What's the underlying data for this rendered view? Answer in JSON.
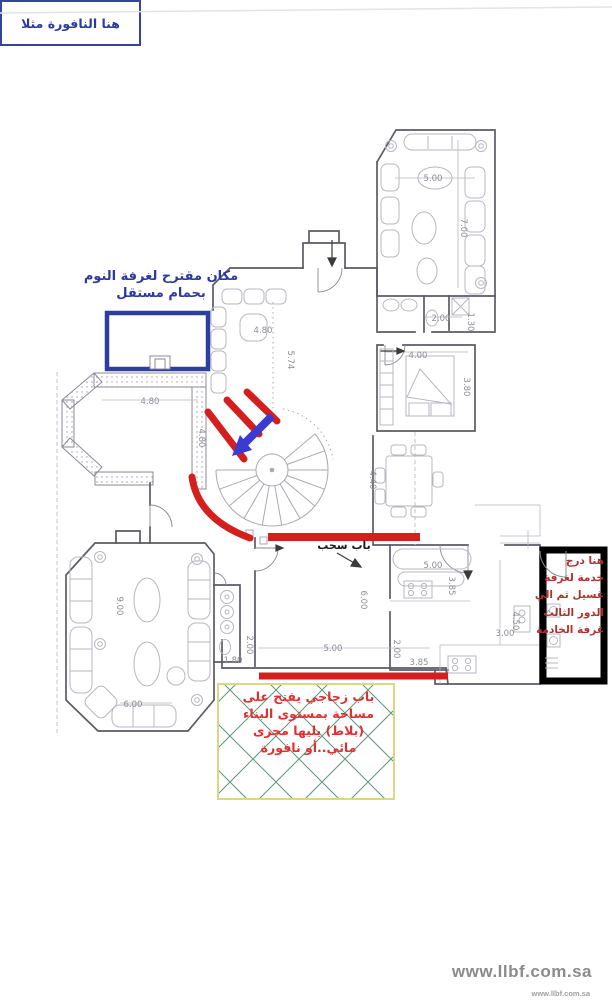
{
  "annotations": {
    "proposed_room": {
      "line1": "مكان مقترح لغرفة النوم",
      "line2": "بحمام مستقل",
      "color": "#2b3aa0"
    },
    "sliding_door": {
      "label": "باب سحب",
      "color": "#1a1a1a"
    },
    "service_stair": {
      "lines": [
        "هنا درج",
        "خدمة لغرفة",
        "غسيل ثم الي",
        "الدور الثالث",
        "غرفة الخادمة"
      ],
      "color": "#b03030"
    },
    "glass_door_note": {
      "lines": [
        "باب زجاجي يفتح على",
        "مساحة بمستوى البناء",
        "(بلاط) يليها مجرى",
        "مائي..أو نافورة"
      ],
      "color": "#e03030"
    },
    "fountain_note": {
      "text": "هنا النافورة مثلا",
      "color": "#2b3aa0"
    }
  },
  "watermark": {
    "large": "www.llbf.com.sa",
    "small": "www.llbf.com.sa"
  },
  "plan": {
    "dimensions": [
      {
        "t": "5.00",
        "x": 433,
        "y": 181,
        "r": 0
      },
      {
        "t": "7.00",
        "x": 461,
        "y": 228,
        "r": 90
      },
      {
        "t": "2.00",
        "x": 441,
        "y": 321,
        "r": 0
      },
      {
        "t": "1.30",
        "x": 468,
        "y": 322,
        "r": 90
      },
      {
        "t": "4.00",
        "x": 418,
        "y": 358,
        "r": 0
      },
      {
        "t": "3.80",
        "x": 464,
        "y": 387,
        "r": 90
      },
      {
        "t": "4.40",
        "x": 370,
        "y": 480,
        "r": 90
      },
      {
        "t": "4.80",
        "x": 263,
        "y": 333,
        "r": 0
      },
      {
        "t": "5.74",
        "x": 288,
        "y": 360,
        "r": 90
      },
      {
        "t": "4.80",
        "x": 150,
        "y": 404,
        "r": 0
      },
      {
        "t": "4.80",
        "x": 199,
        "y": 438,
        "r": 90
      },
      {
        "t": "5.00",
        "x": 433,
        "y": 568,
        "r": 0
      },
      {
        "t": "3.85",
        "x": 449,
        "y": 586,
        "r": 90
      },
      {
        "t": "4.50",
        "x": 513,
        "y": 621,
        "r": 90
      },
      {
        "t": "3.00",
        "x": 505,
        "y": 636,
        "r": 0
      },
      {
        "t": "3.85",
        "x": 419,
        "y": 665,
        "r": 0
      },
      {
        "t": "2.00",
        "x": 394,
        "y": 649,
        "r": 90
      },
      {
        "t": "2.00",
        "x": 247,
        "y": 645,
        "r": 90
      },
      {
        "t": "1.80",
        "x": 233,
        "y": 663,
        "r": 0
      },
      {
        "t": "5.00",
        "x": 333,
        "y": 651,
        "r": 0
      },
      {
        "t": "6.00",
        "x": 361,
        "y": 600,
        "r": 90
      },
      {
        "t": "9.00",
        "x": 117,
        "y": 606,
        "r": 90
      },
      {
        "t": "6.00",
        "x": 133,
        "y": 707,
        "r": 0
      }
    ],
    "colors": {
      "wall_gray": "#5b5b66",
      "furniture_gray": "#b7b7c2",
      "dim_gray": "#8c8c96",
      "annotation_red": "#d41f1f",
      "annotation_blue": "#3b3bd1",
      "proposed_rect_blue": "#2d3f9e",
      "green_hatch": "#5e9678",
      "green_border": "#d9d984",
      "service_box_black": "#000000",
      "watermark_gray": "#8b8b8b"
    }
  }
}
